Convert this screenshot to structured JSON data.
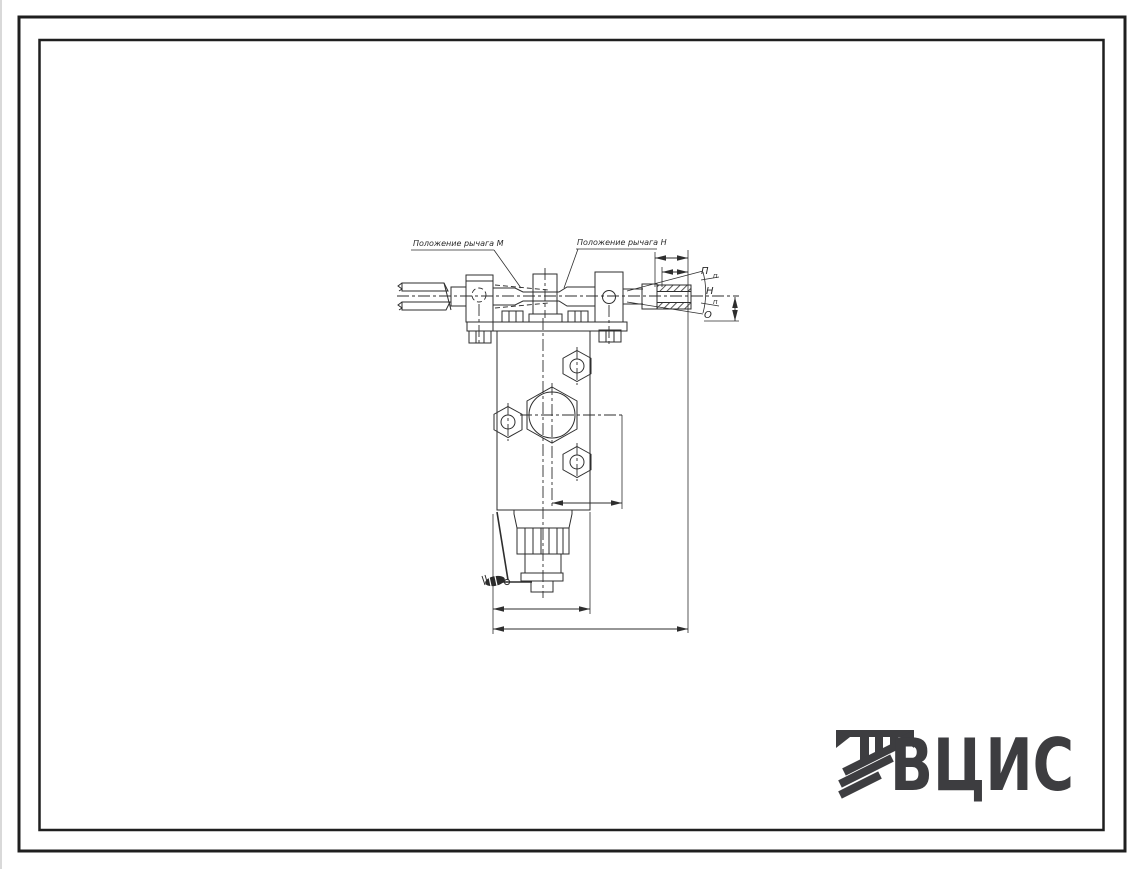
{
  "drawing": {
    "annotations": {
      "lever_position_left": "Положение рычага М",
      "lever_position_right": "Положение рычага Н"
    },
    "lever_positions": {
      "top": "П",
      "upper_small": "п",
      "middle": "Н",
      "lower_small": "п",
      "bottom": "О"
    },
    "logo": {
      "text": "ВЦИС"
    },
    "colors": {
      "line": "#2e2e2e",
      "frame": "#1f1f1f",
      "logo": "#3d3d40",
      "background": "#ffffff"
    }
  }
}
